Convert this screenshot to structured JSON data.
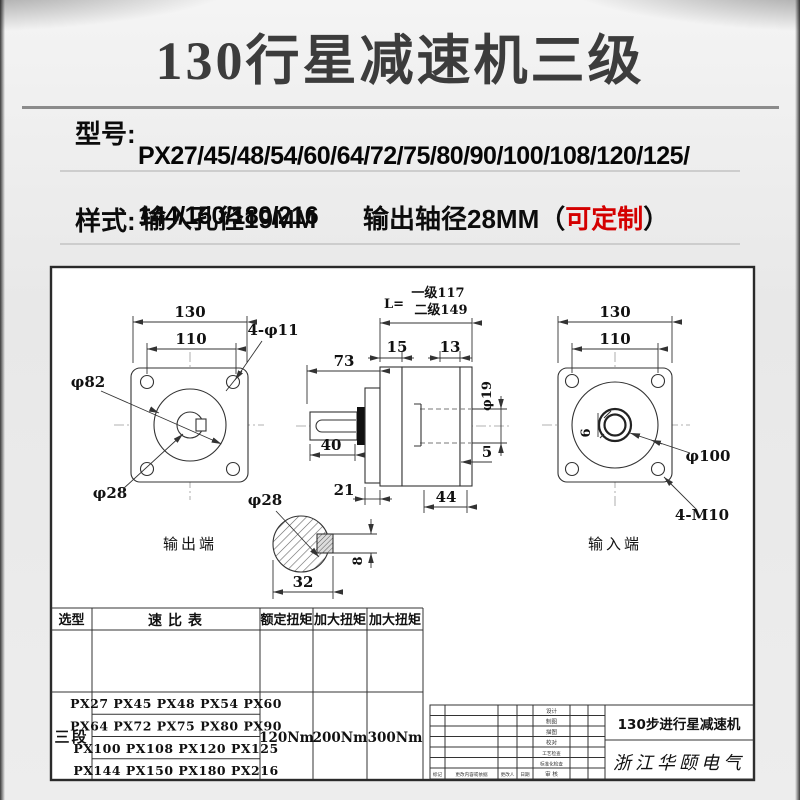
{
  "banner": {
    "title": "130行星减速机三级"
  },
  "model_section": {
    "label": "型号:",
    "line1": "PX27/45/48/54/60/64/72/75/80/90/100/108/120/125/",
    "line2": "144/150/180/216"
  },
  "style_section": {
    "label": "样式:",
    "input_text": "输入孔径19MM",
    "output_text": "输出轴径28MM",
    "bracket_open": "（",
    "custom_text": "可定制",
    "bracket_close": "）"
  },
  "drawing": {
    "left_view": {
      "dim_130": "130",
      "dim_110": "110",
      "holes_label": "4-φ11",
      "dim_phi82": "φ82",
      "dim_phi28": "φ28",
      "caption": "输出端"
    },
    "side_view": {
      "len_prefix": "L=",
      "len_line1": "一级117",
      "len_line2": "二级149",
      "dim_73": "73",
      "dim_15": "15",
      "dim_13": "13",
      "dim_40": "40",
      "dim_21": "21",
      "dim_44": "44",
      "dim_5": "5",
      "dim_phi19": "φ19"
    },
    "shaft_section": {
      "dim_phi28": "φ28",
      "dim_32": "32",
      "dim_8": "8"
    },
    "right_view": {
      "dim_130": "130",
      "dim_110": "110",
      "dim_phi100": "φ100",
      "holes_label": "4-M10",
      "dim_6": "6",
      "caption": "输入端"
    }
  },
  "spec_table": {
    "col_headers": [
      "选型",
      "速比表",
      "额定扭矩",
      "加大扭矩",
      "加大扭矩"
    ],
    "stage_label": "三段",
    "ratio_rows": [
      "PX27 PX45 PX48 PX54 PX60",
      "PX64 PX72 PX75 PX80 PX90",
      "PX100 PX108 PX120 PX125",
      "PX144 PX150 PX180 PX216"
    ],
    "rated_torque": "120Nm",
    "boost_torque_1": "200Nm",
    "boost_torque_2": "300Nm"
  },
  "title_block": {
    "row_labels": [
      "设计",
      "制图",
      "描图",
      "校对",
      "工艺检查",
      "标准化检查"
    ],
    "revision_labels": [
      "标记",
      "更改内容或依据",
      "更改人",
      "日期",
      "审 核"
    ],
    "product_name": "130步进行星减速机",
    "company": "浙江华颐电气"
  },
  "colors": {
    "page_bg": "#e9e9e9",
    "accent_red": "#d40000",
    "title_gray": "#3c3c3c",
    "line_color": "#333333"
  }
}
